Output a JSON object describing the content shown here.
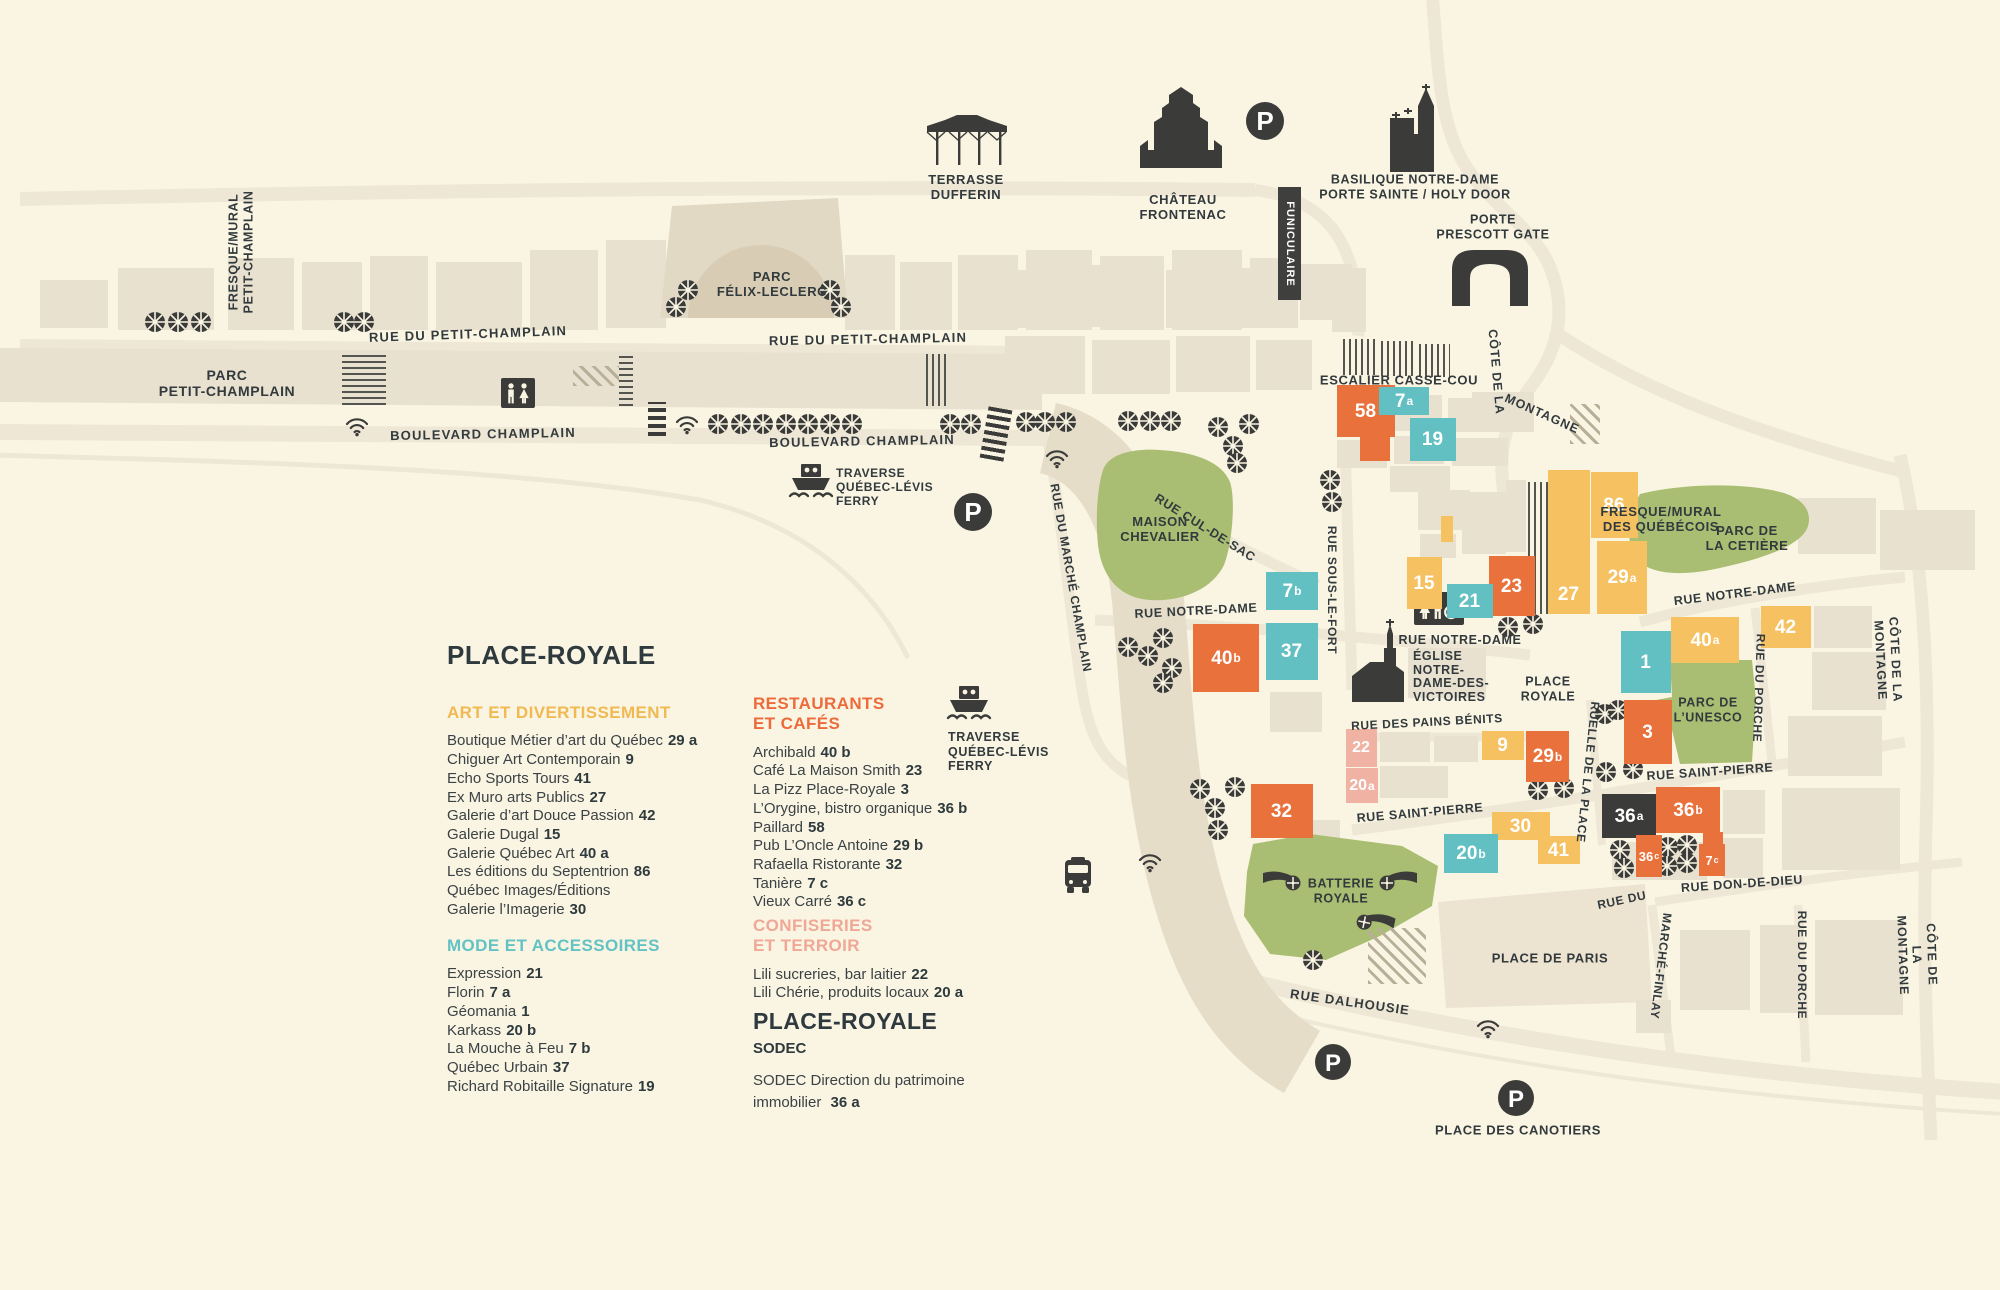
{
  "palette": {
    "background": "#FAF5E3",
    "building": "#E9E1D0",
    "road": "#EFE7D6",
    "promenade": "#E5DDC8",
    "park_green": "#A9BE72",
    "orange": "#E8713C",
    "teal": "#62BFC2",
    "yellow": "#F5C161",
    "pink": "#F0B2A2",
    "dark": "#3B3B39",
    "ink": "#323A3D",
    "header_yellow": "#F0B951",
    "header_teal": "#63C2C3",
    "header_orange": "#ED6A3B",
    "header_pink": "#F0A795"
  },
  "legend": {
    "title": "PLACE-ROYALE",
    "sections": [
      {
        "id": "art",
        "title": "ART ET DIVERTISSEMENT",
        "items": [
          {
            "name": "Boutique Métier d’art du Québec",
            "num": "29 a"
          },
          {
            "name": "Chiguer Art Contemporain",
            "num": "9"
          },
          {
            "name": "Echo Sports Tours",
            "num": "41"
          },
          {
            "name": "Ex Muro arts Publics",
            "num": "27"
          },
          {
            "name": "Galerie d’art Douce Passion",
            "num": "42"
          },
          {
            "name": "Galerie Dugal",
            "num": "15"
          },
          {
            "name": "Galerie Québec Art",
            "num": "40 a"
          },
          {
            "name": "Les éditions du Septentrion",
            "num": "86"
          },
          {
            "name": "Québec Images/Éditions",
            "num": ""
          },
          {
            "name": "Galerie l’Imagerie",
            "num": "30"
          }
        ]
      },
      {
        "id": "mode",
        "title": "MODE ET ACCESSOIRES",
        "items": [
          {
            "name": "Expression",
            "num": "21"
          },
          {
            "name": "Florin",
            "num": "7 a"
          },
          {
            "name": "Géomania",
            "num": "1"
          },
          {
            "name": "Karkass",
            "num": "20 b"
          },
          {
            "name": "La Mouche à Feu",
            "num": "7 b"
          },
          {
            "name": "Québec Urbain",
            "num": "37"
          },
          {
            "name": "Richard Robitaille Signature",
            "num": "19"
          }
        ]
      },
      {
        "id": "resto",
        "title": "RESTAURANTS\nET CAFÉS",
        "items": [
          {
            "name": "Archibald",
            "num": "40 b"
          },
          {
            "name": "Café La Maison Smith",
            "num": "23"
          },
          {
            "name": "La Pizz Place-Royale",
            "num": "3"
          },
          {
            "name": "L’Orygine, bistro organique",
            "num": "36 b"
          },
          {
            "name": "Paillard",
            "num": "58"
          },
          {
            "name": "Pub L’Oncle Antoine",
            "num": "29 b"
          },
          {
            "name": "Rafaella Ristorante",
            "num": "32"
          },
          {
            "name": "Tanière",
            "num": "7 c"
          },
          {
            "name": "Vieux Carré",
            "num": "36 c"
          }
        ]
      },
      {
        "id": "conf",
        "title": "CONFISERIES\nET TERROIR",
        "items": [
          {
            "name": "Lili sucreries, bar laitier",
            "num": "22"
          },
          {
            "name": "Lili Chérie, produits locaux",
            "num": "20 a"
          }
        ]
      }
    ],
    "sodec": {
      "title": "PLACE-ROYALE",
      "org": "SODEC",
      "body": "SODEC Direction du patrimoine immobilier",
      "num": "36 a"
    }
  },
  "landmarks": {
    "terrasse": "TERRASSE\nDUFFERIN",
    "chateau": "CHÂTEAU\nFRONTENAC",
    "basilique": "BASILIQUE NOTRE-DAME\nPORTE SAINTE / HOLY DOOR",
    "porte": "PORTE\nPRESCOTT GATE",
    "funiculaire": "FUNICULAIRE",
    "escalier": "ESCALIER CASSE-COU",
    "fresque_petit_champlain": "FRESQUE/MURAL\nPETIT-CHAMPLAIN",
    "fresque_quebecois": "FRESQUE/MURAL\nDES QUÉBÉCOIS",
    "parc_petit_champlain": "PARC\nPETIT-CHAMPLAIN",
    "parc_felix": "PARC\nFÉLIX-LECLERC",
    "parc_cetiere": "PARC DE\nLA CETIÈRE",
    "parc_unesco": "PARC DE\nL’UNESCO",
    "maison_chevalier": "MAISON\nCHEVALIER",
    "eglise": "ÉGLISE\nNOTRE-\nDAME-DES-\nVICTOIRES",
    "place_royale": "PLACE\nROYALE",
    "batterie": "BATTERIE\nROYALE",
    "place_paris": "PLACE DE PARIS",
    "place_canotiers": "PLACE DES CANOTIERS",
    "traverse": "TRAVERSE\nQUÉBEC-LÉVIS\nFERRY",
    "parking": "P"
  },
  "streets": {
    "petit_champlain": "RUE DU PETIT-CHAMPLAIN",
    "boulevard": "BOULEVARD CHAMPLAIN",
    "cul_de_sac": "RUE CUL-DE-SAC",
    "marche_champlain": "RUE DU MARCHÉ CHAMPLAIN",
    "sous_le_fort": "RUE SOUS-LE-FORT",
    "notre_dame": "RUE NOTRE-DAME",
    "pains_benits": "RUE DES PAINS BÉNITS",
    "ruelle_place": "RUELLE DE LA PLACE",
    "saint_pierre": "RUE SAINT-PIERRE",
    "porche": "RUE DU PORCHE",
    "don_de_dieu": "RUE DON-DE-DIEU",
    "rue_du": "RUE DU",
    "marche_finlay": "MARCHÉ-FINLAY",
    "dalhousie": "RUE DALHOUSIE",
    "cote": "CÔTE DE LA",
    "montagne": "MONTAGNE",
    "cote_montagne": "CÔTE DE LA MONTAGNE"
  },
  "map": {
    "blocks": [
      {
        "n": "58",
        "s": "",
        "c": "orange"
      },
      {
        "n": "7",
        "s": "a",
        "c": "teal"
      },
      {
        "n": "19",
        "s": "",
        "c": "teal"
      },
      {
        "n": "86",
        "s": "",
        "c": "yellow"
      },
      {
        "n": "27",
        "s": "",
        "c": "yellow"
      },
      {
        "n": "29",
        "s": "a",
        "c": "yellow"
      },
      {
        "n": "23",
        "s": "",
        "c": "orange"
      },
      {
        "n": "15",
        "s": "",
        "c": "yellow"
      },
      {
        "n": "21",
        "s": "",
        "c": "teal"
      },
      {
        "n": "7",
        "s": "b",
        "c": "teal"
      },
      {
        "n": "37",
        "s": "",
        "c": "teal"
      },
      {
        "n": "40",
        "s": "b",
        "c": "orange"
      },
      {
        "n": "1",
        "s": "",
        "c": "teal"
      },
      {
        "n": "3",
        "s": "",
        "c": "orange"
      },
      {
        "n": "40",
        "s": "a",
        "c": "yellow"
      },
      {
        "n": "42",
        "s": "",
        "c": "yellow"
      },
      {
        "n": "9",
        "s": "",
        "c": "yellow"
      },
      {
        "n": "29",
        "s": "b",
        "c": "orange"
      },
      {
        "n": "22",
        "s": "",
        "c": "pink"
      },
      {
        "n": "20",
        "s": "a",
        "c": "pink"
      },
      {
        "n": "30",
        "s": "",
        "c": "yellow"
      },
      {
        "n": "41",
        "s": "",
        "c": "yellow"
      },
      {
        "n": "20",
        "s": "b",
        "c": "teal"
      },
      {
        "n": "36",
        "s": "a",
        "c": "dark"
      },
      {
        "n": "36",
        "s": "b",
        "c": "orange"
      },
      {
        "n": "36",
        "s": "c",
        "c": "orange"
      },
      {
        "n": "7",
        "s": "c",
        "c": "orange"
      },
      {
        "n": "32",
        "s": "",
        "c": "orange"
      }
    ]
  }
}
